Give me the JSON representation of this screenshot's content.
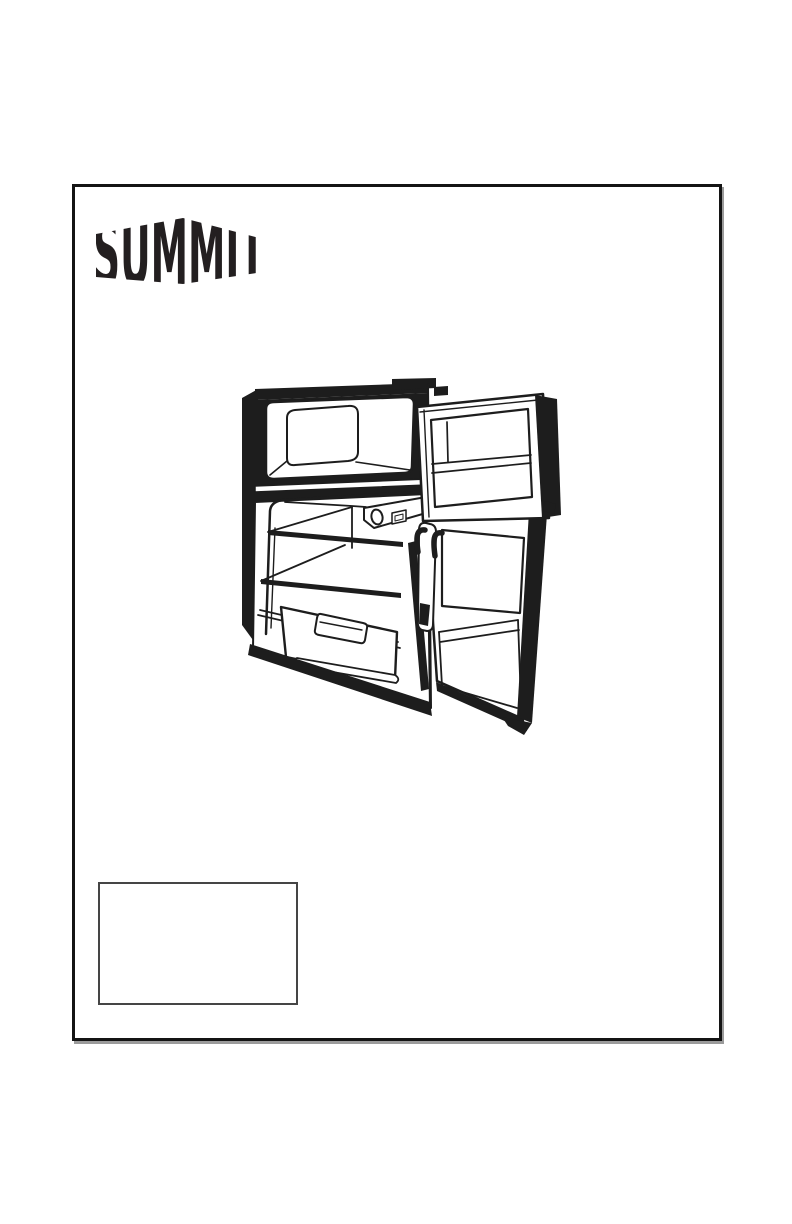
{
  "page": {
    "background": "#ffffff",
    "border_color": "#141414"
  },
  "logo": {
    "text": "SUMMIT",
    "color": "#231f20"
  },
  "illustration": {
    "name": "compact-two-door-refrigerator-freezer-open-doors-line-drawing",
    "ink_color": "#1d1d1d",
    "parts": [
      "cabinet",
      "freezer-compartment",
      "freezer-door",
      "refrigerator-compartment",
      "thermostat",
      "wire-shelves",
      "glass-shelf",
      "crisper-drawer",
      "refrigerator-door",
      "door-hinge-hooks"
    ]
  },
  "label_box": {
    "text": ""
  }
}
